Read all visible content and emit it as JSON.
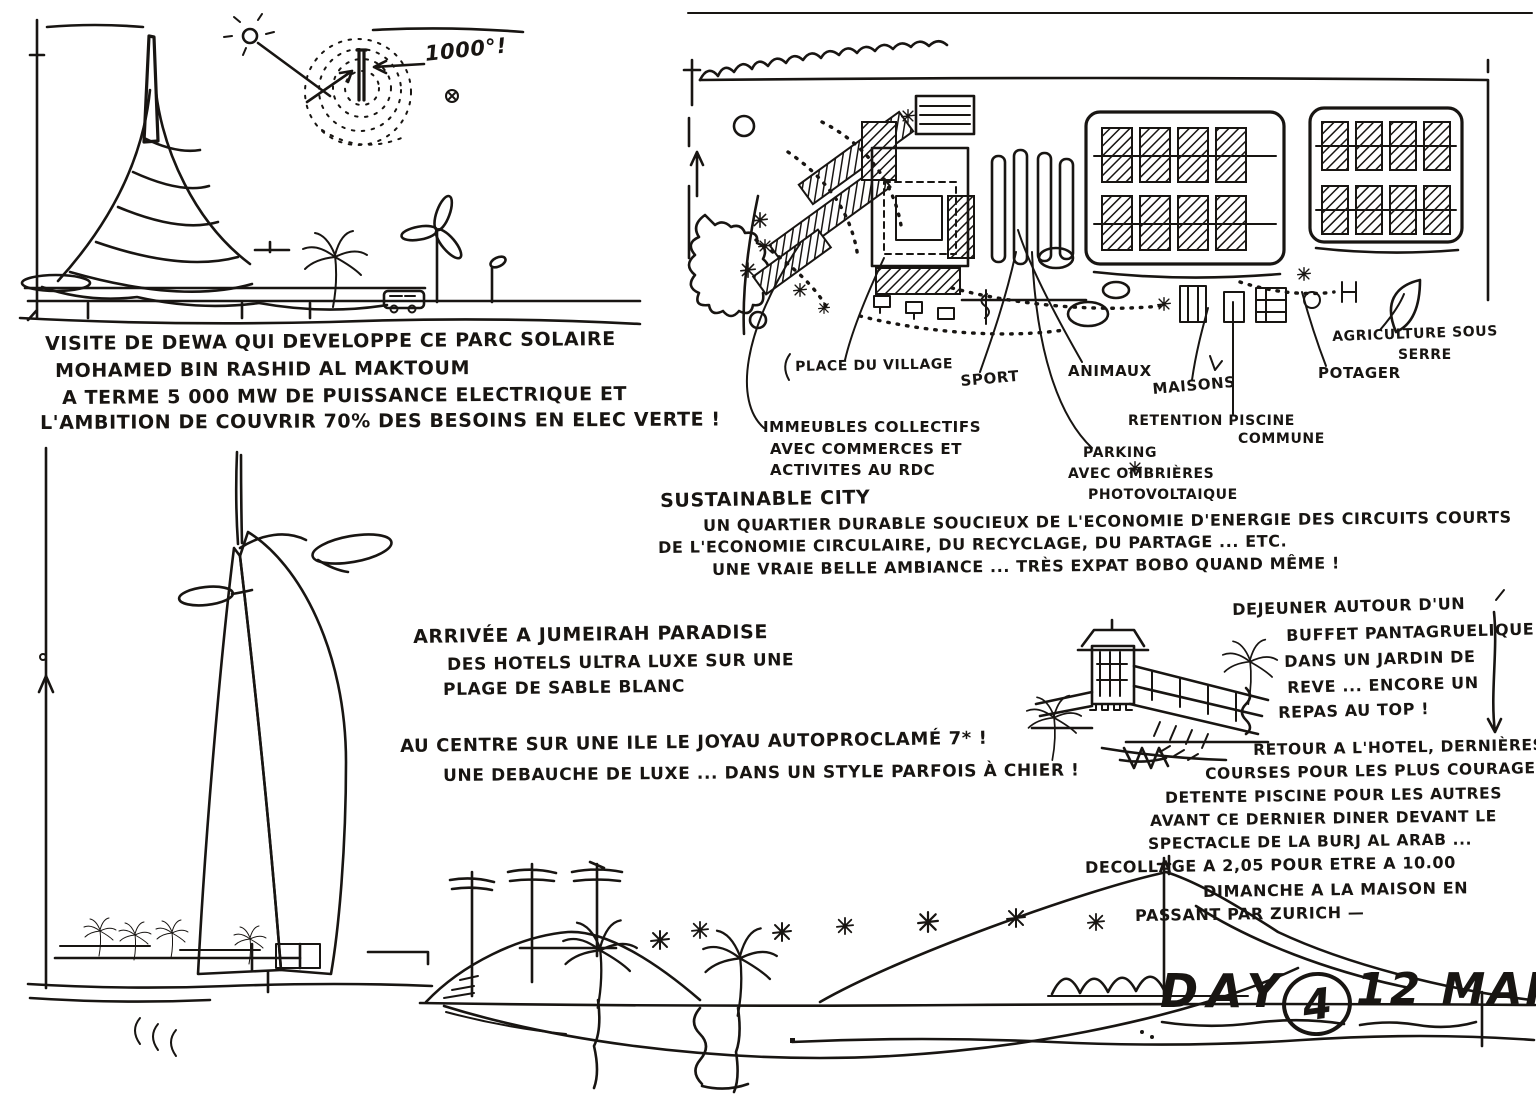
{
  "ink_color": "#181512",
  "paper_color": "#ffffff",
  "title_block": {
    "day_word": "DAY",
    "day_number": "4",
    "date": "12 MARS"
  },
  "solar_park": {
    "heliostat_label": "1000°!",
    "notes": [
      "VISITE DE DEWA QUI DEVELOPPE CE PARC SOLAIRE",
      "MOHAMED BIN RASHID AL MAKTOUM",
      "A TERME 5 000 MW DE PUISSANCE ELECTRIQUE ET",
      "L'AMBITION DE COUVRIR 70% DES BESOINS EN ELEC VERTE !"
    ]
  },
  "sustainable_city": {
    "title": "SUSTAINABLE CITY",
    "notes": [
      "UN QUARTIER DURABLE SOUCIEUX DE L'ECONOMIE D'ENERGIE DES CIRCUITS COURTS",
      "DE L'ECONOMIE CIRCULAIRE, DU RECYCLAGE, DU PARTAGE ... ETC.",
      "UNE VRAIE BELLE AMBIANCE ... TRÈS EXPAT BOBO QUAND MÊME !"
    ],
    "plan_labels": {
      "place_du_village": "PLACE DU VILLAGE",
      "sport": "SPORT",
      "animaux": "ANIMAUX",
      "maisons": "MAISONS",
      "retention_line1": "RETENTION PISCINE",
      "retention_line2": "COMMUNE",
      "potager": "POTAGER",
      "agriculture_line1": "AGRICULTURE SOUS",
      "agriculture_line2": "SERRE",
      "immeubles": [
        "IMMEUBLES COLLECTIFS",
        "AVEC COMMERCES ET",
        "ACTIVITES AU RDC"
      ],
      "parking": [
        "PARKING",
        "AVEC OMBRIÈRES",
        "PHOTOVOLTAIQUE"
      ]
    }
  },
  "jumeirah_paradise": {
    "notes": [
      "ARRIVÉE A JUMEIRAH PARADISE",
      "DES HOTELS ULTRA LUXE SUR UNE",
      "PLAGE DE SABLE BLANC"
    ]
  },
  "burj_comment": {
    "notes": [
      "AU CENTRE SUR UNE ILE LE JOYAU AUTOPROCLAMÉ 7* !",
      "UNE DEBAUCHE DE LUXE ... DANS UN STYLE PARFOIS À CHIER !"
    ]
  },
  "lunch": {
    "notes": [
      "DEJEUNER AUTOUR D'UN",
      "BUFFET PANTAGRUELIQUE",
      "DANS UN JARDIN DE",
      "REVE ... ENCORE UN",
      "REPAS AU TOP !"
    ]
  },
  "evening": {
    "notes": [
      "RETOUR A L'HOTEL, DERNIÈRES",
      "COURSES POUR LES PLUS COURAGEUX",
      "DETENTE PISCINE POUR LES AUTRES",
      "AVANT CE DERNIER DINER DEVANT LE",
      "SPECTACLE DE LA BURJ AL ARAB ..."
    ]
  },
  "departure": {
    "notes": [
      "DECOLLAGE A 2,05 POUR ETRE A 10.00",
      "DIMANCHE A LA MAISON EN",
      "PASSANT PAR ZURICH —"
    ]
  }
}
